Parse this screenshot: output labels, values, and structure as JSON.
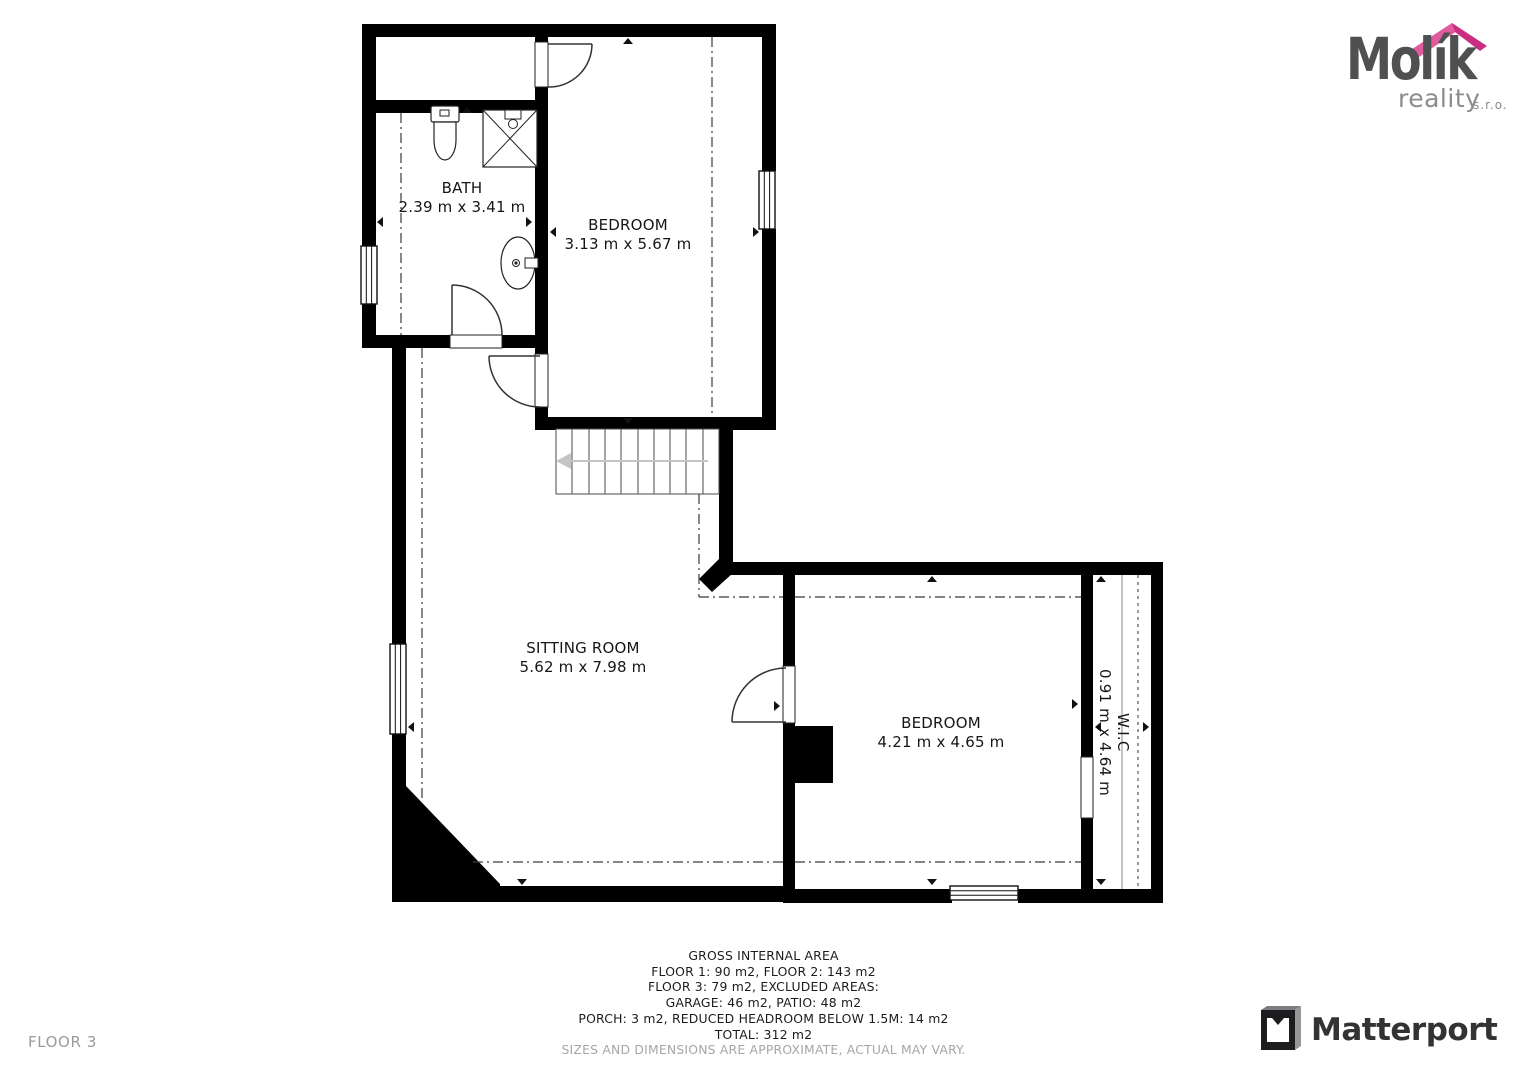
{
  "plan": {
    "floor_label": "FLOOR 3",
    "rooms": {
      "bath": {
        "name": "BATH",
        "dims": "2.39 m x 3.41 m"
      },
      "bedroom_top": {
        "name": "BEDROOM",
        "dims": "3.13 m x 5.67 m"
      },
      "sitting_room": {
        "name": "SITTING ROOM",
        "dims": "5.62 m x 7.98 m"
      },
      "bedroom_right": {
        "name": "BEDROOM",
        "dims": "4.21 m x 4.65 m"
      },
      "wic": {
        "name": "W.I.C",
        "dims": "0.91 m x 4.64 m"
      }
    }
  },
  "footer": {
    "area_summary": [
      "GROSS INTERNAL AREA",
      "FLOOR 1: 90 m2, FLOOR 2: 143 m2",
      "FLOOR 3: 79 m2, EXCLUDED AREAS:",
      "GARAGE: 46 m2, PATIO: 48 m2",
      "PORCH: 3 m2, REDUCED HEADROOM BELOW 1.5M: 14 m2",
      "TOTAL: 312 m2"
    ],
    "disclaimer": "SIZES AND DIMENSIONS ARE APPROXIMATE, ACTUAL MAY VARY."
  },
  "branding": {
    "molik": {
      "name": "Molík",
      "subtitle": "reality",
      "suffix": "s.r.o."
    },
    "matterport": "Matterport"
  },
  "colors": {
    "wall": "#000000",
    "molik_pink": "#d9388f",
    "molik_gray": "#4f5052",
    "muted_text": "#9b9b9b"
  }
}
